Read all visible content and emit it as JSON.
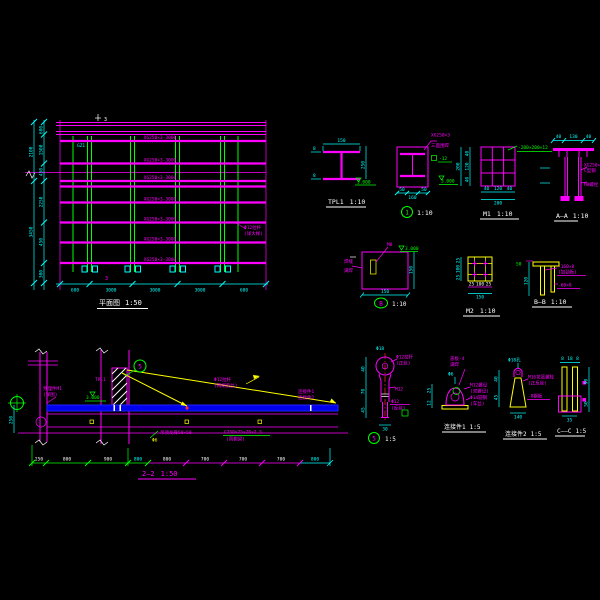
{
  "app": {
    "background": "#000000"
  },
  "colors": {
    "magenta": "#FF00FF",
    "green": "#00FF00",
    "cyan": "#00FFFF",
    "yellow": "#FFFF00",
    "white": "#FFFFFF",
    "blue": "#0000EE",
    "red": "#FF2A2A"
  },
  "plan": {
    "title": "平面图",
    "scale": "1:50",
    "beam_label": "XG250×3-3000",
    "note1": "Φ12拉杆",
    "note2": "(详大样)",
    "col_label": "GZ1",
    "section_mark": "3",
    "dims_left_inner": [
      "600",
      "1500",
      "450",
      "2250",
      "450",
      "300"
    ],
    "dims_left_outer": [
      "2100",
      "3450"
    ],
    "dims_bottom": [
      "600",
      "3000",
      "3000",
      "3000",
      "600"
    ]
  },
  "tpl1": {
    "title": "TPL1",
    "scale": "1:10",
    "dim_top": "150",
    "dim_right": "250",
    "dim_flange": "8",
    "level": "3.000"
  },
  "d1": {
    "num": "1",
    "scale": "1:10",
    "leader1": "XG250×3",
    "leader2": "三面围焊",
    "plate_note": "-12",
    "level": "3.000",
    "dims_bottom": [
      "50",
      "160",
      "50"
    ]
  },
  "m1": {
    "title": "M1",
    "scale": "1:10",
    "note": "-200×200×12",
    "dims_left": [
      "40",
      "120",
      "40"
    ],
    "dims_bottom": [
      "40",
      "120",
      "40"
    ],
    "dim_outer": "200"
  },
  "aa": {
    "title": "A—A",
    "scale": "1:10",
    "dims_top": [
      "40",
      "130",
      "40"
    ],
    "leader1a": "XG250×3",
    "leader1b": "C型钢",
    "leader2": "M8螺栓"
  },
  "db": {
    "letter": "B",
    "scale": "1:10",
    "top_label": "M8",
    "note1": "焊缝",
    "note2": "满焊",
    "level": "3.000",
    "dim_right": "150",
    "dim_bottom": "150"
  },
  "m2": {
    "title": "M2",
    "scale": "1:10",
    "dims_left": [
      "25",
      "100",
      "25"
    ],
    "dims_bottom": [
      "25",
      "100",
      "25"
    ],
    "dim_outer": "150"
  },
  "bb": {
    "title": "B—B",
    "scale": "1:10",
    "leader1a": "-160×8",
    "leader1b": "(加劲板)",
    "leader2": "-60×8",
    "dim_green": "50",
    "dim_left": "120"
  },
  "elev": {
    "title": "2—2",
    "scale": "1:50",
    "note_left1": "预埋件M1",
    "note_left2": "(详图)",
    "mid_label": "TPL1",
    "level": "3.000",
    "callout": "5",
    "rod_note1": "Φ12拉杆",
    "rod_note2": "(两端反丝)",
    "end_note1": "连接件1",
    "end_note2": "连接件2",
    "soffit_note1": "吊顶龙骨50×50",
    "soffit_note2a": "C250×75×20×2.5",
    "soffit_note2b": "(雨棚梁)",
    "tiny_note": "Φ6",
    "dim_left": "250",
    "dims_bottom": [
      "250",
      "800",
      "900",
      "800",
      "800",
      "700",
      "700",
      "700",
      "800"
    ]
  },
  "d5": {
    "num": "5",
    "scale": "1:5",
    "dim_top": "Φ18",
    "r1a": "Φ12拉杆",
    "r1b": "(正丝)",
    "r2": "M12",
    "r3a": "Φ12",
    "r3b": "(反丝)",
    "dims_left": [
      "40",
      "70",
      "45"
    ],
    "dim_bottom": "30"
  },
  "lj1": {
    "title": "连接件1",
    "scale": "1:5",
    "top1": "盖板-4",
    "top2": "满焊",
    "r1a": "M12螺母",
    "r1b": "(双螺母)",
    "r2a": "Φ14圆钢",
    "r2b": "(车丝)",
    "dim_top": "Φ6",
    "dims_left": [
      "25",
      "12"
    ]
  },
  "lj2": {
    "title": "连接件2",
    "scale": "1:5",
    "r1a": "M16花篮螺栓",
    "r1b": "(正反丝)",
    "r2": "-8钢板",
    "dim_top": "Φ18孔",
    "dims_left": [
      "40",
      "45"
    ],
    "dim_bottom": "140"
  },
  "cc": {
    "title": "C——C",
    "scale": "1:5",
    "dims_top": [
      "8",
      "18",
      "8"
    ],
    "dims_right": [
      "90",
      "50"
    ],
    "dim_bottom": "35"
  }
}
